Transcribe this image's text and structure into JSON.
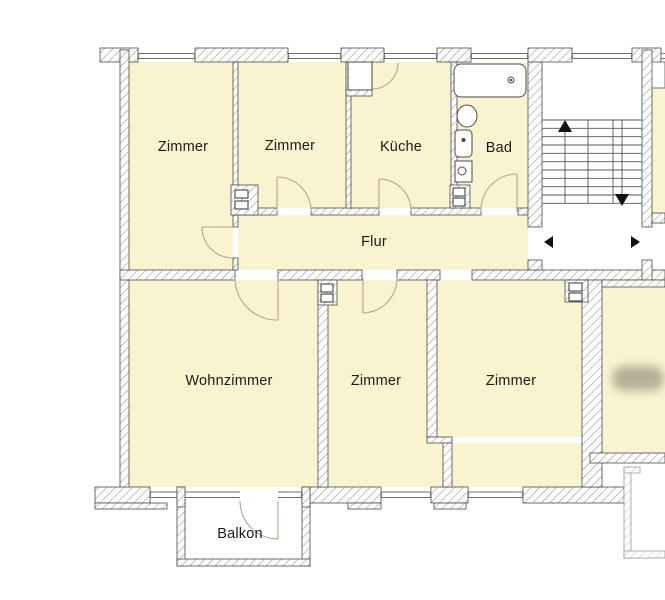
{
  "floorplan": {
    "rooms": {
      "zimmer_top_left": "Zimmer",
      "zimmer_top_mid": "Zimmer",
      "kueche": "Küche",
      "bad": "Bad",
      "flur": "Flur",
      "wohnzimmer": "Wohnzimmer",
      "zimmer_bottom_mid": "Zimmer",
      "zimmer_bottom_right": "Zimmer",
      "balkon": "Balkon"
    },
    "colors": {
      "room_fill": "#faf3cf",
      "wall_outline": "#4a4a4a",
      "hatch_line": "#8f8f8f",
      "door_arc": "#b3a78c",
      "label_text": "#1a1a1a",
      "stair_line": "#555555",
      "arrow": "#111111"
    }
  }
}
